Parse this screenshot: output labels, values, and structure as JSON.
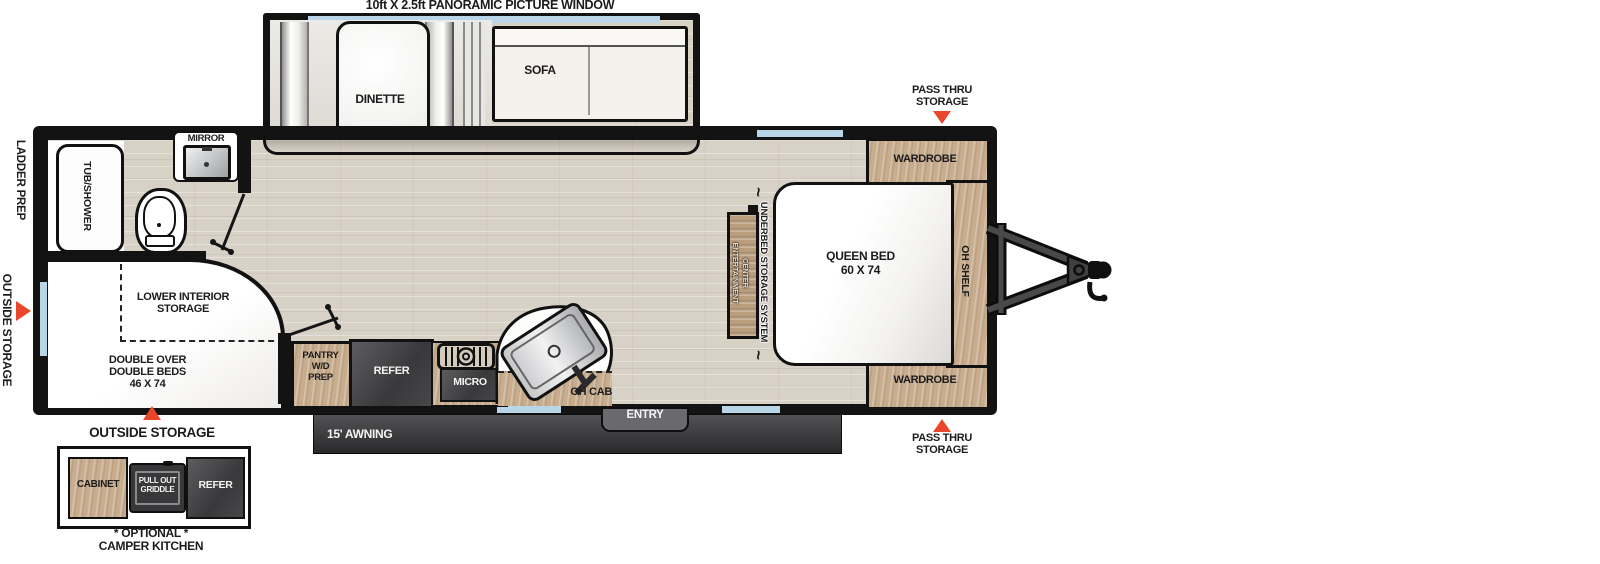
{
  "title": "10ft X 2.5ft PANORAMIC PICTURE WINDOW",
  "slide_out": {
    "dinette": "DINETTE",
    "sofa": "SOFA"
  },
  "bathroom": {
    "tub_shower": "TUB/SHOWER",
    "mirror": "MIRROR"
  },
  "front_bedroom": {
    "lower_storage": [
      "LOWER INTERIOR",
      "STORAGE"
    ],
    "double_beds": [
      "DOUBLE OVER",
      "DOUBLE BEDS",
      "46 X 74"
    ]
  },
  "kitchen": {
    "pantry": [
      "PANTRY",
      "W/D",
      "PREP"
    ],
    "refer": "REFER",
    "micro": "MICRO",
    "oh_cab": "OH CAB"
  },
  "rear_bedroom": {
    "wardrobe_top": "WARDROBE",
    "wardrobe_bottom": "WARDROBE",
    "queen_bed": [
      "QUEEN BED",
      "60 X 74"
    ],
    "oh_shelf": "OH SHELF",
    "underbed": "UNDERBED STORAGE SYSTEM",
    "entertainment": [
      "ENTERTAINMENT",
      "CENTER"
    ],
    "squiggle": "~"
  },
  "exterior": {
    "ladder_prep": "LADDER PREP",
    "outside_storage_side": "OUTSIDE STORAGE",
    "outside_storage_bottom": "OUTSIDE STORAGE",
    "pass_thru_top": [
      "PASS THRU",
      "STORAGE"
    ],
    "pass_thru_bottom": [
      "PASS THRU",
      "STORAGE"
    ],
    "entry": "ENTRY",
    "awning": "15' AWNING"
  },
  "camper_kitchen": {
    "cabinet": "CABINET",
    "griddle": [
      "PULL OUT",
      "GRIDDLE"
    ],
    "refer": "REFER",
    "caption": [
      "* OPTIONAL *",
      "CAMPER KITCHEN"
    ]
  },
  "colors": {
    "wall": "#131313",
    "floor_wood": "#d8d1c6",
    "cabinet_wood": "#c7ad8e",
    "dark_unit": "#434345",
    "window_glass": "#b9d5e8",
    "arrow_red": "#e8472b",
    "awning_dark": "#3a3a3c"
  }
}
